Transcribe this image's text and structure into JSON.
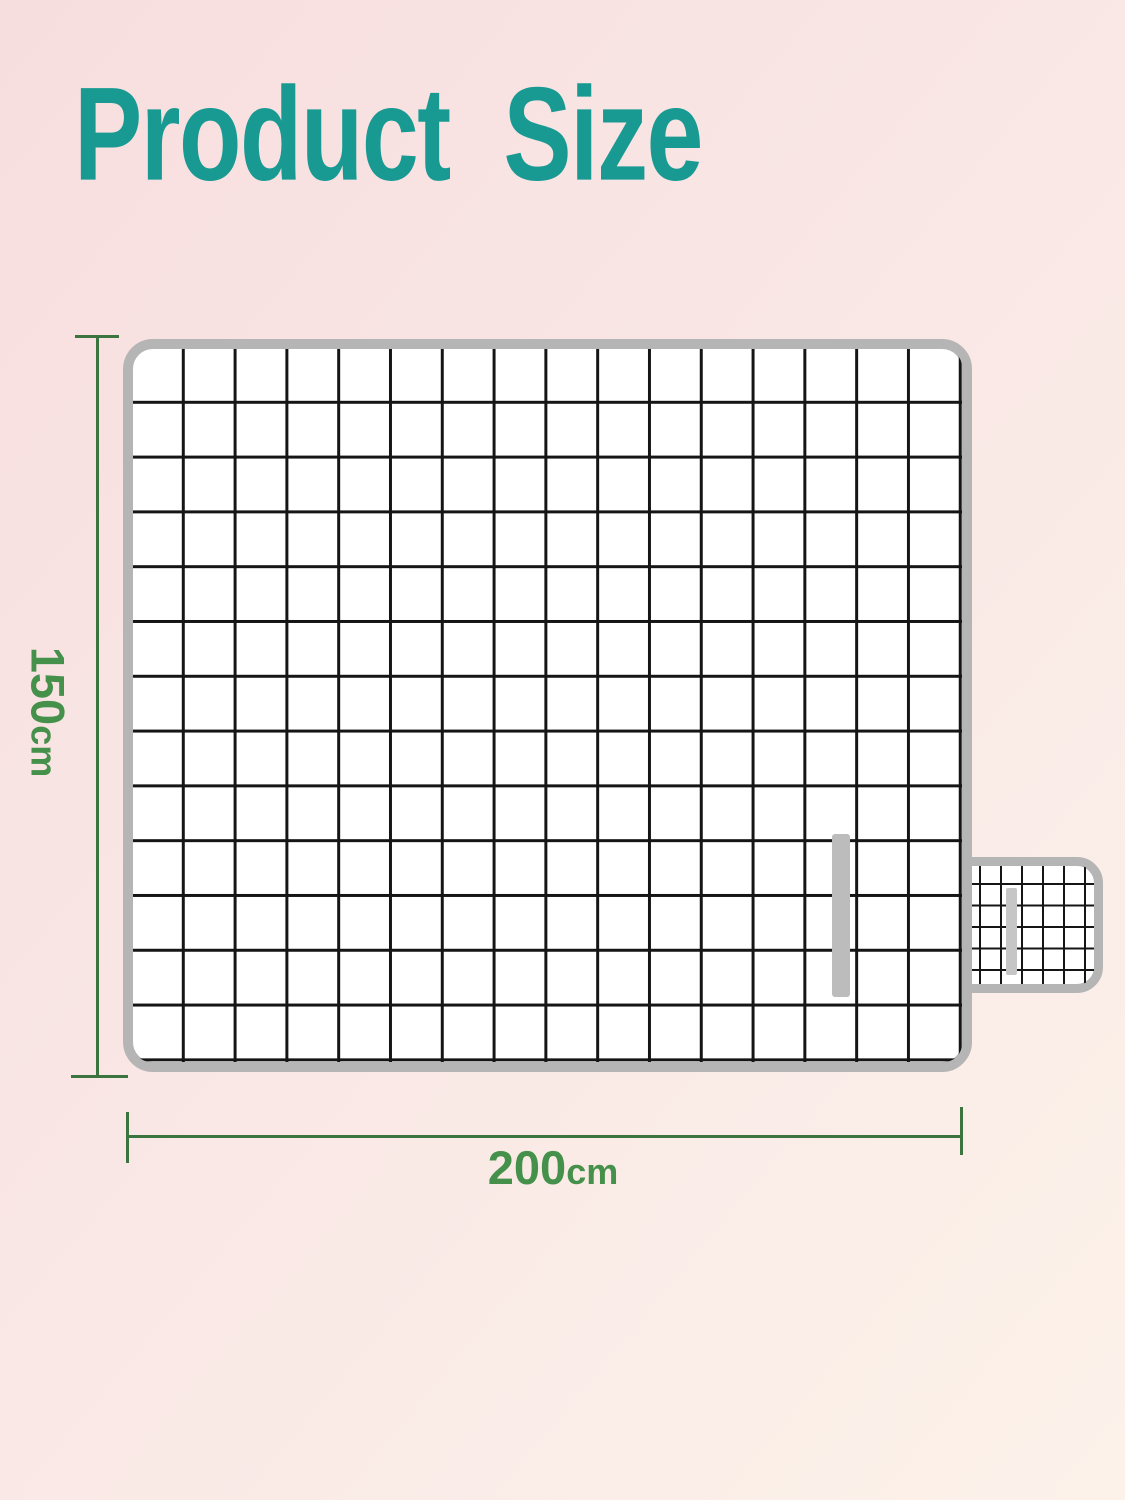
{
  "title": "Product  Size",
  "diagram": {
    "subject": "picnic-blanket-top-view",
    "dimensions": {
      "height": {
        "value": "150",
        "unit": "cm"
      },
      "width": {
        "value": "200",
        "unit": "cm"
      }
    },
    "blanket": {
      "grid_columns": 16,
      "grid_rows": 13,
      "pattern": "black windowpane grid on white",
      "border": "gray rounded edge",
      "strap": "gray vertical velcro strap near right side",
      "side_tab": "small fine-grid carry tab on right edge with gray strap"
    }
  },
  "colors": {
    "title_teal": "#189a93",
    "dimension_text": "#45914b",
    "dimension_line": "#3c7440",
    "blanket_border": "#b5b5b5",
    "grid_line": "#151515",
    "blanket_fill": "#ffffff",
    "strap_gray": "#bcbcbc",
    "tab_strap_gray": "#c6c6c6",
    "bg_start": "#f7dede",
    "bg_mid": "#f9e7e5",
    "bg_end": "#fcf2ea"
  }
}
